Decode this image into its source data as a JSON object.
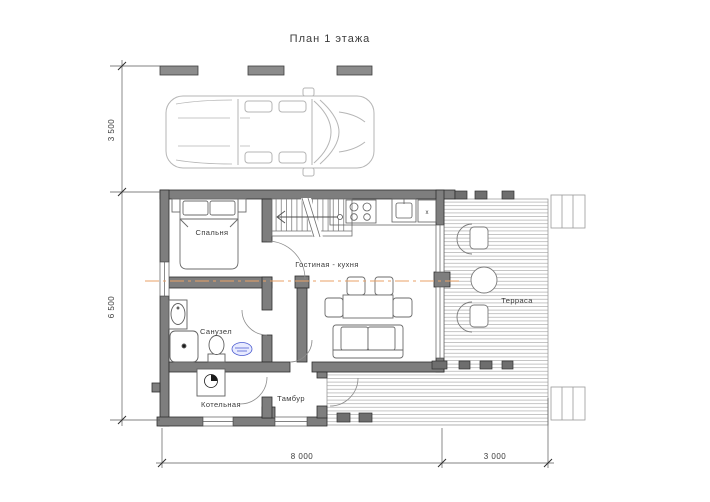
{
  "title": "План 1 этажа",
  "rooms": {
    "bedroom": "Спальня",
    "living_kitchen": "Гостиная - кухня",
    "bathroom": "Санузел",
    "boiler_room": "Котельная",
    "vestibule": "Тамбур",
    "terrace": "Терраса"
  },
  "kitchen": {
    "fridge_mark": "x"
  },
  "dimensions": {
    "vertical": [
      {
        "label": "3 500"
      },
      {
        "label": "6 500"
      }
    ],
    "horizontal": [
      {
        "label": "8 000"
      },
      {
        "label": "3 000"
      }
    ]
  },
  "colors": {
    "wall_fill": "#7e7e7e",
    "wall_stroke": "#2e2e2e",
    "axis_line": "#e9a267",
    "stamp_blue": "#4a5bd0",
    "drawing_line": "#4f4f4f",
    "light_line": "#b5b5b5",
    "deck_line": "#9f9f9f"
  }
}
